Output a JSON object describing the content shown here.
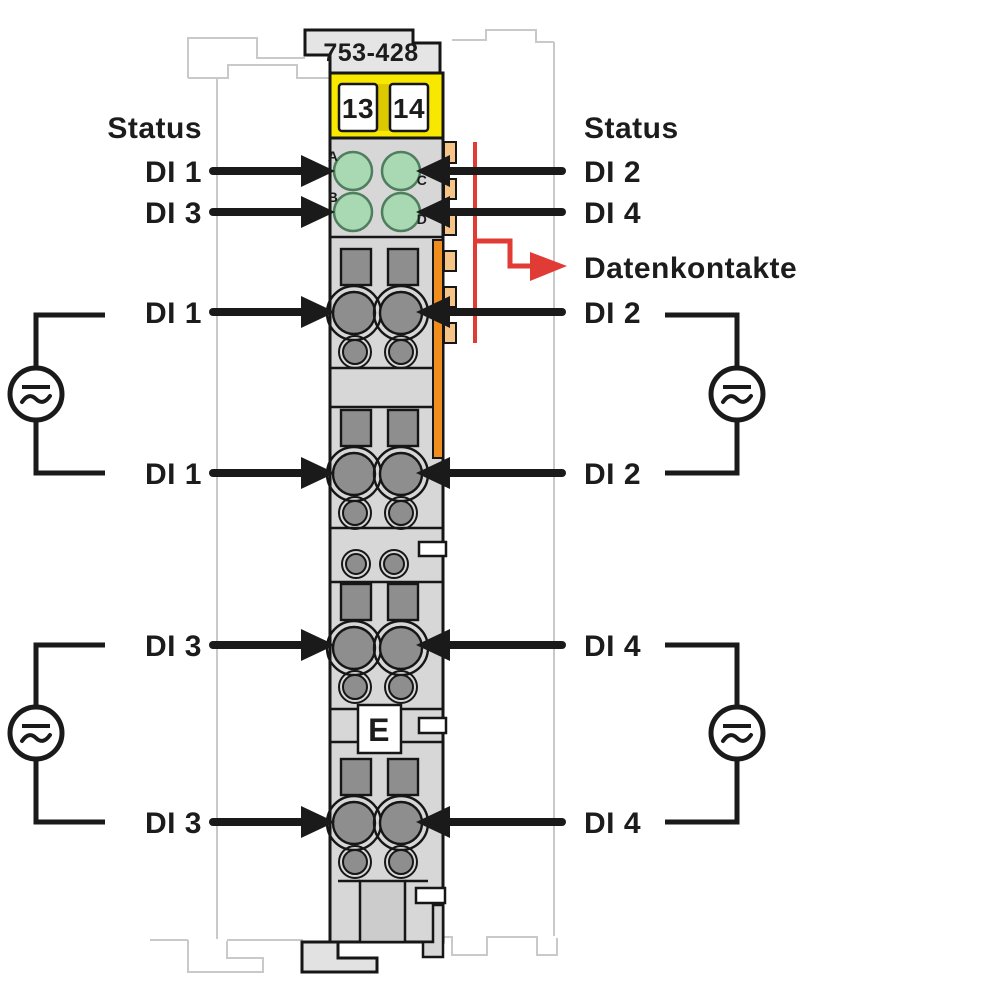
{
  "diagram": {
    "part_number": "753-428",
    "terminals": {
      "t13": "13",
      "t14": "14"
    },
    "marking_e": "E",
    "led_letters": {
      "a": "A",
      "b": "B",
      "c": "C",
      "d": "D"
    },
    "labels": {
      "left": [
        "Status",
        "DI 1",
        "DI 3",
        "DI 1",
        "DI 1",
        "DI 3",
        "DI 3"
      ],
      "right": [
        "Status",
        "DI 2",
        "DI 4",
        "Datenkontakte",
        "DI 2",
        "DI 2",
        "DI 4",
        "DI 4"
      ]
    },
    "colors": {
      "led_green": "#a9d9b2",
      "terminal_yellow": "#f8e800",
      "latch_orange": "#ef8d1f",
      "latch_orange_light": "#f7c488",
      "data_contact_red": "#e03b35",
      "contact_gray": "#8e8e8e"
    }
  }
}
